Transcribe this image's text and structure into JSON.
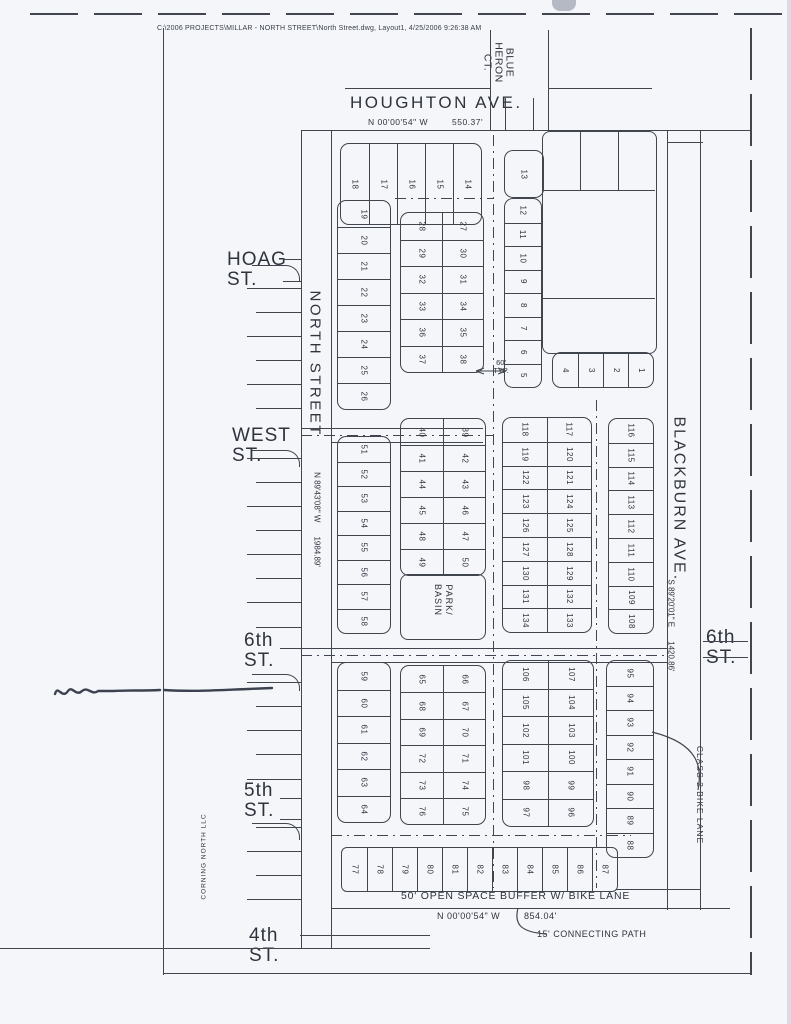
{
  "header": {
    "file_info": "C:\\2006 PROJECTS\\MILLAR - NORTH STREET\\North Street.dwg, Layout1, 4/25/2006 9:26:38 AM"
  },
  "streets": {
    "houghton": "HOUGHTON AVE.",
    "blue_heron_lines": [
      "BLUE",
      "HERON",
      "CT."
    ],
    "hoag_lines": [
      "HOAG",
      "ST."
    ],
    "west_lines": [
      "WEST",
      "ST."
    ],
    "north_street": "NORTH STREET",
    "blackburn": "BLACKBURN AVE.",
    "sixth_left_lines": [
      "6th",
      "ST."
    ],
    "sixth_right_lines": [
      "6th",
      "ST."
    ],
    "fifth_lines": [
      "5th",
      "ST."
    ],
    "fourth_lines": [
      "4th",
      "ST."
    ]
  },
  "bearings": {
    "houghton_bearing": "N 00'00'54\" W",
    "houghton_distance": "550.37'",
    "west_bearing": "N 89'43'08\" W",
    "west_distance": "1984.89'",
    "east_bearing": "S 89'20'01\" E",
    "east_distance": "1420.86'",
    "south_bearing": "N 00'00'54\" W",
    "south_distance": "854.04'"
  },
  "annotations": {
    "lot_width_lines": [
      "60'",
      "TYP."
    ],
    "park_lines": [
      "PARK/",
      "BASIN"
    ],
    "bike_lane": "CLASS 2 BIKE LANE",
    "open_space": "50' OPEN SPACE BUFFER W/ BIKE LANE",
    "connecting_path": "15' CONNECTING PATH",
    "owner": "CORNING NORTH LLC"
  },
  "colors": {
    "paper": "#f4f6fa",
    "ink": "#41454d",
    "pen": "#1c2230"
  },
  "blocks": {
    "top_row": [
      [
        "18"
      ],
      [
        "17"
      ],
      [
        "16"
      ],
      [
        "15"
      ],
      [
        "14"
      ]
    ],
    "lot_13": [
      [
        "13"
      ]
    ],
    "ne_col": [
      [
        "12",
        "11",
        "10",
        "9",
        "8",
        "7",
        "6",
        "5"
      ]
    ],
    "se_row": [
      [
        "4"
      ],
      [
        "3"
      ],
      [
        "2"
      ],
      [
        "1"
      ]
    ],
    "west_col_1": [
      [
        "19",
        "20",
        "21",
        "22",
        "23",
        "24",
        "25",
        "26"
      ]
    ],
    "mid_grid_1": [
      [
        "28",
        "29",
        "32",
        "33",
        "36",
        "37"
      ],
      [
        "27",
        "30",
        "31",
        "34",
        "35",
        "38"
      ]
    ],
    "west_col_2": [
      [
        "51",
        "52",
        "53",
        "54",
        "55",
        "56",
        "57",
        "58"
      ]
    ],
    "mid_grid_2": [
      [
        "40",
        "41",
        "44",
        "45",
        "48",
        "49"
      ],
      [
        "39",
        "42",
        "43",
        "46",
        "47",
        "50"
      ]
    ],
    "east_grid_1": [
      [
        "118",
        "119",
        "122",
        "123",
        "126",
        "127",
        "130",
        "131",
        "134"
      ],
      [
        "117",
        "120",
        "121",
        "124",
        "125",
        "128",
        "129",
        "132",
        "133"
      ]
    ],
    "east_col_1": [
      [
        "116",
        "115",
        "114",
        "113",
        "112",
        "111",
        "110",
        "109",
        "108"
      ]
    ],
    "west_col_3": [
      [
        "59",
        "60",
        "61",
        "62",
        "63",
        "64"
      ]
    ],
    "mid_grid_3": [
      [
        "65",
        "68",
        "69",
        "72",
        "73",
        "76"
      ],
      [
        "66",
        "67",
        "70",
        "71",
        "74",
        "75"
      ]
    ],
    "east_grid_2": [
      [
        "106",
        "105",
        "102",
        "101",
        "98",
        "97"
      ],
      [
        "107",
        "104",
        "103",
        "100",
        "99",
        "96"
      ]
    ],
    "east_col_2": [
      [
        "95",
        "94",
        "93",
        "92",
        "91",
        "90",
        "89",
        "88"
      ]
    ],
    "south_row": [
      [
        "77"
      ],
      [
        "78"
      ],
      [
        "79"
      ],
      [
        "80"
      ],
      [
        "81"
      ],
      [
        "82"
      ],
      [
        "83"
      ],
      [
        "84"
      ],
      [
        "85"
      ],
      [
        "86"
      ],
      [
        "87"
      ]
    ]
  }
}
